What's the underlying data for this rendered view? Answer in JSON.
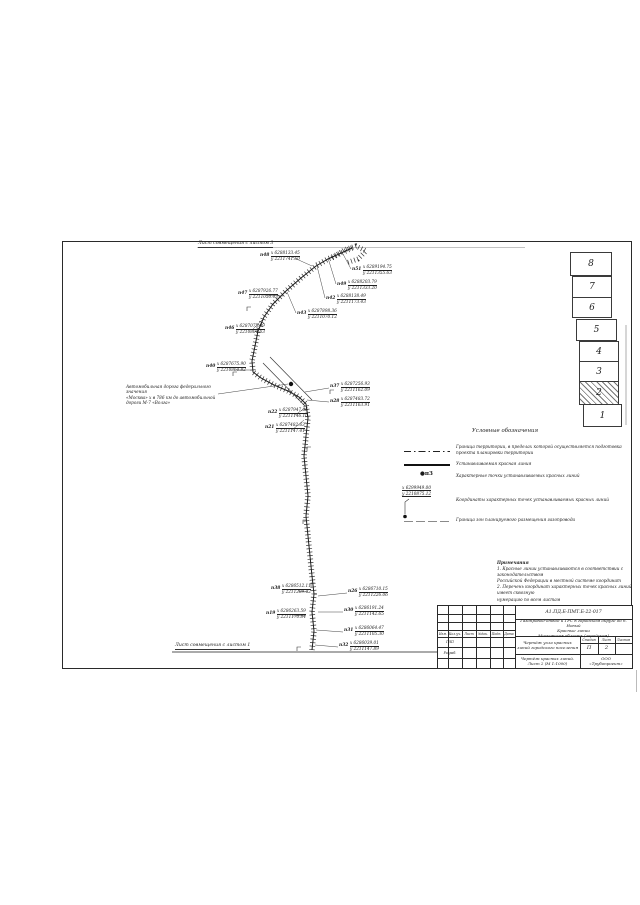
{
  "drawing": {
    "match_line_top": "Лист совмещения с листом 3",
    "match_line_bottom": "Лист совмещения с листом 1",
    "road_label_lines": {
      "l1": "Автомобильная дорога федерального значения",
      "l2": "«Москва» х в 786 км до автомобильной",
      "l3": "дороги М-7 «Волга»"
    },
    "callouts": [
      {
        "id": "п48",
        "x": "х 6288133.45",
        "y": "у 2211741.50"
      },
      {
        "id": "п51",
        "x": "х 6289194.75",
        "y": "у 2211355.63"
      },
      {
        "id": "п49",
        "x": "х 6288203.79",
        "y": "у 2211333.20"
      },
      {
        "id": "п42",
        "x": "х 6288138.49",
        "y": "у 2211173.43"
      },
      {
        "id": "п43",
        "x": "х 6287898.36",
        "y": "у 2211070.12"
      },
      {
        "id": "п47",
        "x": "х 6287926.77",
        "y": "у 2211050.43"
      },
      {
        "id": "п46",
        "x": "х 6287075.89",
        "y": "у 2210804.63"
      },
      {
        "id": "п40",
        "x": "х 6287675.90",
        "y": "у 2210864.82"
      },
      {
        "id": "п37",
        "x": "х 6287256.93",
        "y": "у 2211162.09"
      },
      {
        "id": "п28",
        "x": "х 6287483.72",
        "y": "у 2211163.91"
      },
      {
        "id": "п22",
        "x": "х 6287947.06",
        "y": "у 2211146.10"
      },
      {
        "id": "п21",
        "x": "х 6287482.63",
        "y": "у 2211147.41"
      },
      {
        "id": "п38",
        "x": "х 6286512.11",
        "y": "у 2211209.42"
      },
      {
        "id": "п26",
        "x": "х 6286710.15",
        "y": "у 2211226.06"
      },
      {
        "id": "п19",
        "x": "х 6286263.59",
        "y": "у 2211170.84"
      },
      {
        "id": "п30",
        "x": "х 6286191.24",
        "y": "у 2211142.65"
      },
      {
        "id": "п31",
        "x": "х 6286064.47",
        "y": "у 2211105.30"
      },
      {
        "id": "п32",
        "x": "х 6286039.01",
        "y": "у 2211147.89"
      }
    ]
  },
  "sheet_index": {
    "boxes": [
      "8",
      "7",
      "6",
      "5",
      "4",
      "3",
      "2",
      "1"
    ],
    "current_sheet": "2"
  },
  "legend": {
    "title": "Условные обозначения",
    "items": [
      {
        "symbol": "boundary-dashdot-line",
        "text": "Граница территории, в пределах которой осуществляется подготовка проекта планировки территории"
      },
      {
        "symbol": "red-line-solid",
        "text": "Устанавливаемая красная линия"
      },
      {
        "symbol": "point-marker",
        "sample": "п3",
        "text": "Характерные точки устанавливаемых красных линий"
      },
      {
        "symbol": "coords-sample",
        "sample_x": "х 6299949.00",
        "sample_y": "у 2210875.12",
        "text": "Координаты характерных точек устанавливаемых красных линий"
      },
      {
        "symbol": "zone-thin-line",
        "text": "Граница зон планируемого размещения газопровода"
      }
    ]
  },
  "notes": {
    "title": "Примечания",
    "lines": [
      "1. Красные линии устанавливаются в соответствии с законодательством",
      "Российской Федерации в местной системе координат",
      "2. Перечень координат характерных точек красных линий имеет сквозную",
      "нумерацию по всем листам"
    ]
  },
  "title_block": {
    "doc_code": "А1.ПД.Б-ПМТ.Б-22-017",
    "project_lines": {
      "l1": "Газопровод-отвод и ГРС в городском округе до п. Новый",
      "l2": "Красные линии",
      "l3": "Московская область (городская)"
    },
    "columns": [
      "Изм.",
      "Кол.уч.",
      "Лист",
      "№док.",
      "Подп.",
      "Дата"
    ],
    "roles": [
      "ГИП",
      "Разраб."
    ],
    "drawing_title_lines": {
      "l1": "Чертёж узла красных",
      "l2": "линий городского поселения"
    },
    "stage_header": [
      "Стадия",
      "Лист",
      "Листов"
    ],
    "stage_values": [
      "П",
      "2",
      ""
    ],
    "sheet_caption": "Чертёж красных линий. Лист 2 (М 1:1000)",
    "company_lines": {
      "l1": "ООО",
      "l2": "«Трубопроект»"
    }
  }
}
